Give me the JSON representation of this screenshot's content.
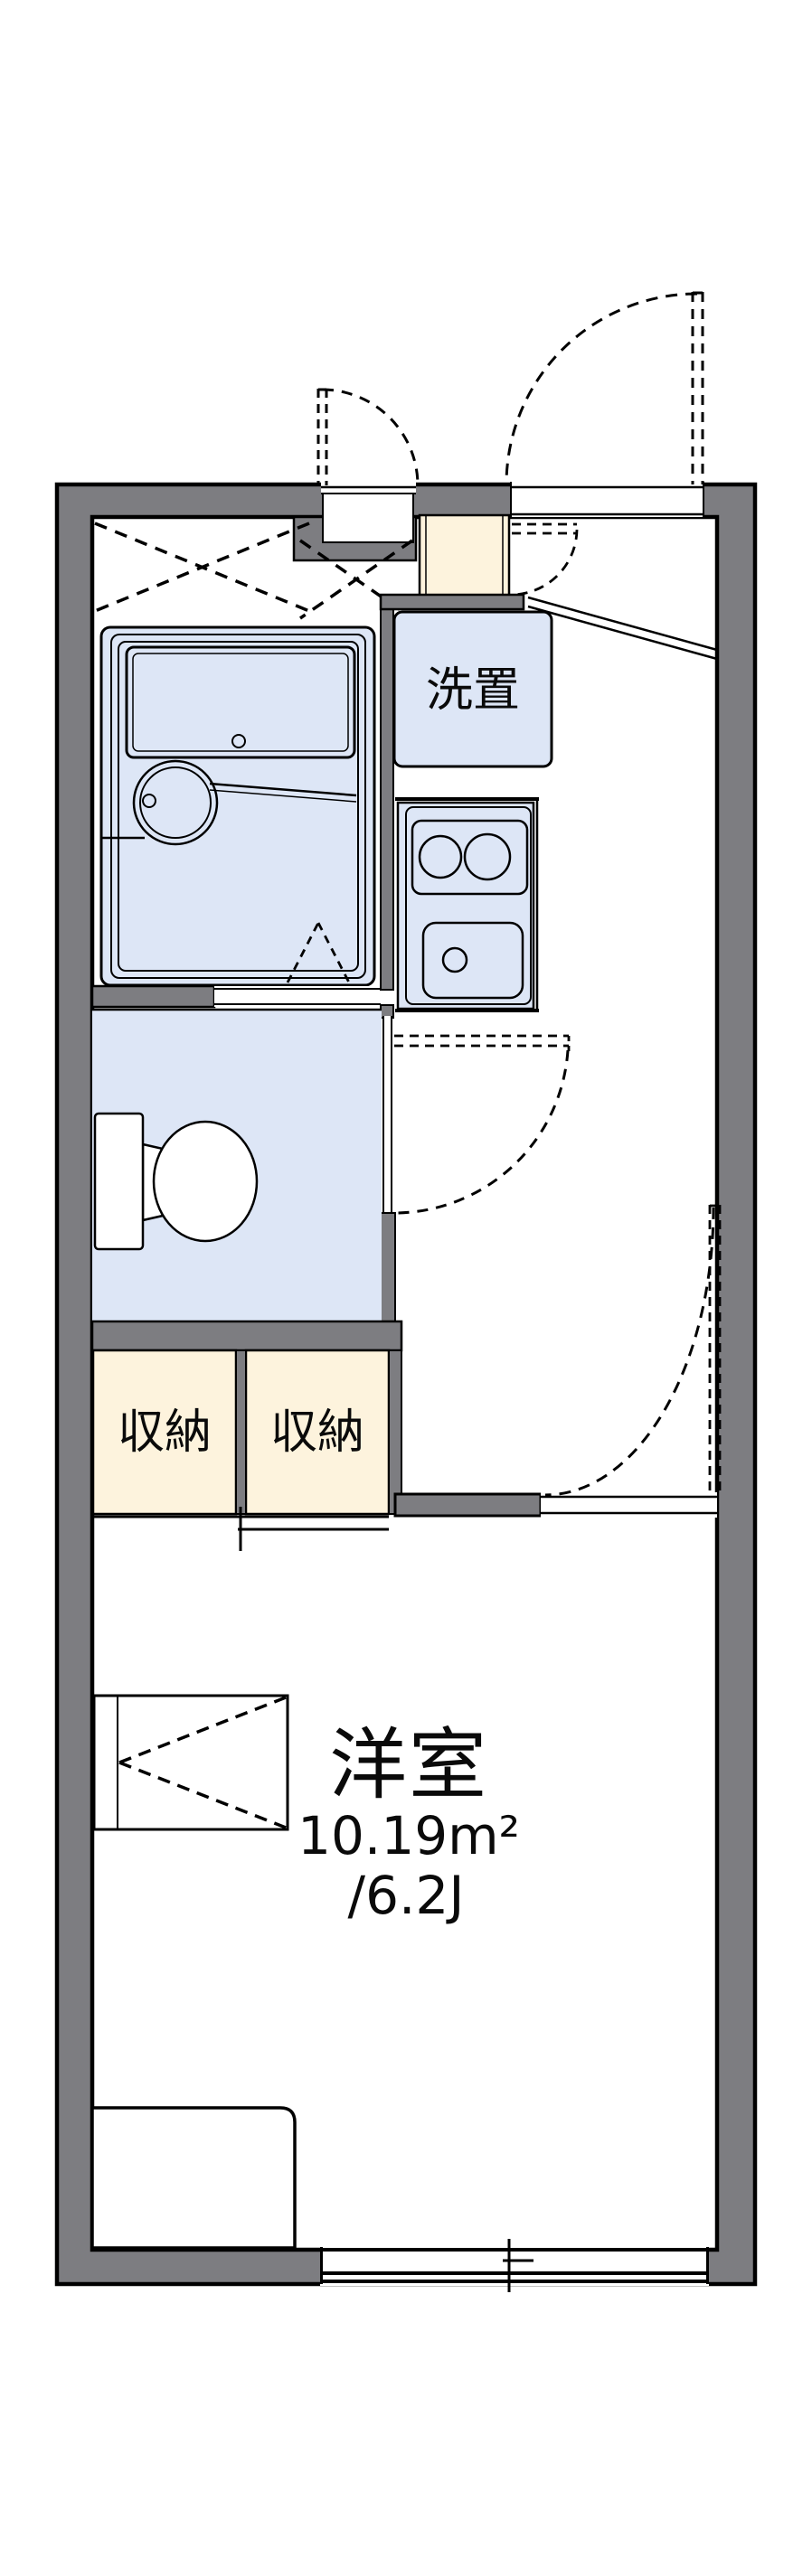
{
  "plan": {
    "type": "japanese-apartment-floorplan",
    "labels": {
      "laundry": "洗置",
      "storage_left": "収納",
      "storage_right": "収納",
      "room_name": "洋室",
      "room_area_m2": "10.19m²",
      "room_area_tatami": "/6.2J"
    },
    "colors": {
      "wall": "#7d7d81",
      "fixture_fill": "#dde6f6",
      "storage_fill": "#fdf3dd",
      "line": "#000000",
      "background": "#ffffff"
    }
  }
}
